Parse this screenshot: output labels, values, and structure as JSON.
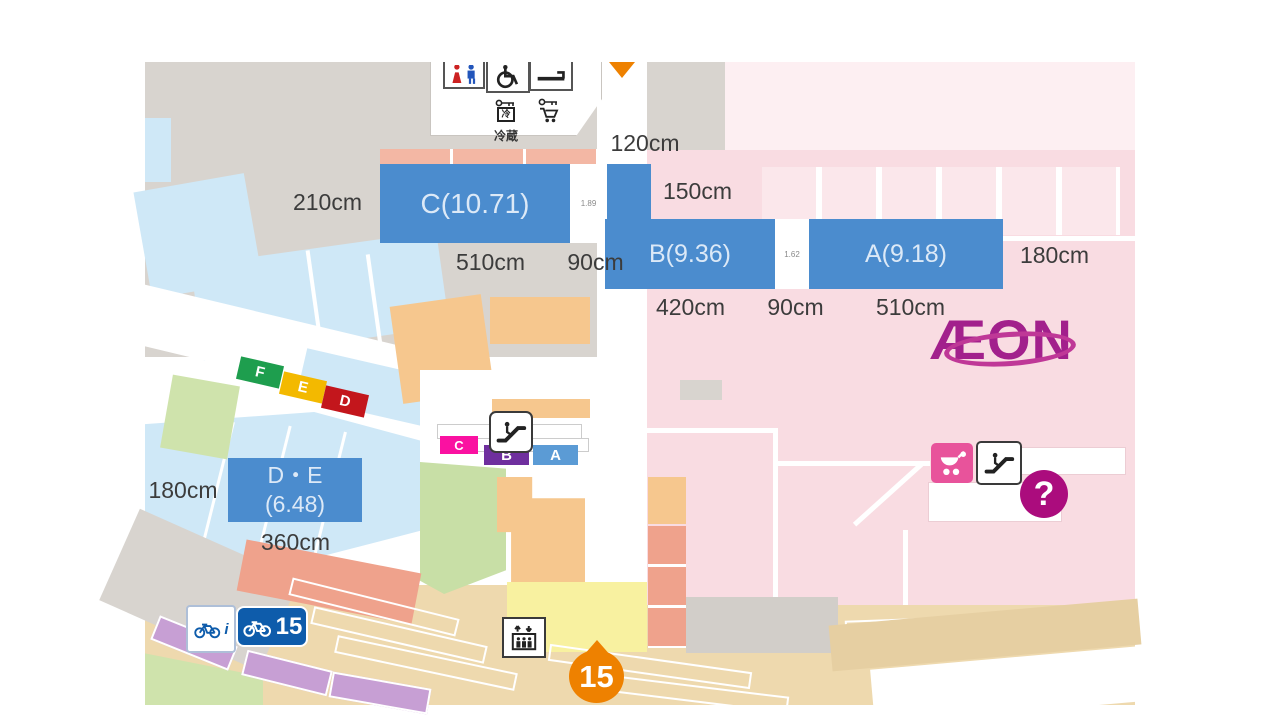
{
  "map": {
    "logo": "ÆON",
    "measurements": {
      "top": "120cm",
      "left_c": "210cm",
      "right_small": "150cm",
      "c_width": "510cm",
      "c_gap": "90cm",
      "b_width": "420cm",
      "ba_gap": "90cm",
      "a_width": "510cm",
      "a_right": "180cm",
      "de_left": "180cm",
      "de_width": "360cm"
    },
    "zones": {
      "c": "C(10.71)",
      "b": "B(9.36)",
      "a": "A(9.18)",
      "de_line1": "D・E",
      "de_line2": "(6.48)",
      "gap_c": "1.89",
      "gap_ba": "1.62"
    },
    "markers": {
      "f": "F",
      "e": "E",
      "d": "D",
      "c": "C",
      "b": "B",
      "a": "A"
    },
    "signs": {
      "bicycle_count": "15",
      "pin_number": "15",
      "question": "?",
      "locker_label": "冷蔵",
      "locker_cold": "冷",
      "bike_info": "i"
    },
    "colors": {
      "zone_box_blue": "#4b8cce",
      "aeon_magenta": "#a2208c",
      "pin_orange": "#ee8100",
      "marker_f_green": "#1e9e4e",
      "marker_e_yellow": "#f3b900",
      "marker_d_red": "#c3161c",
      "marker_c_magenta": "#fa11a1",
      "marker_b_purple": "#6f2f9e",
      "marker_a_blue": "#5b9bd5",
      "bike_sign_blue": "#0e5cab",
      "question_magenta": "#ab0c7d",
      "building_pink": "#f9dce2",
      "parking_blue": "#cfe8f7",
      "road_gray": "#d8d4cf",
      "parking_tan": "#eed9ae"
    }
  }
}
